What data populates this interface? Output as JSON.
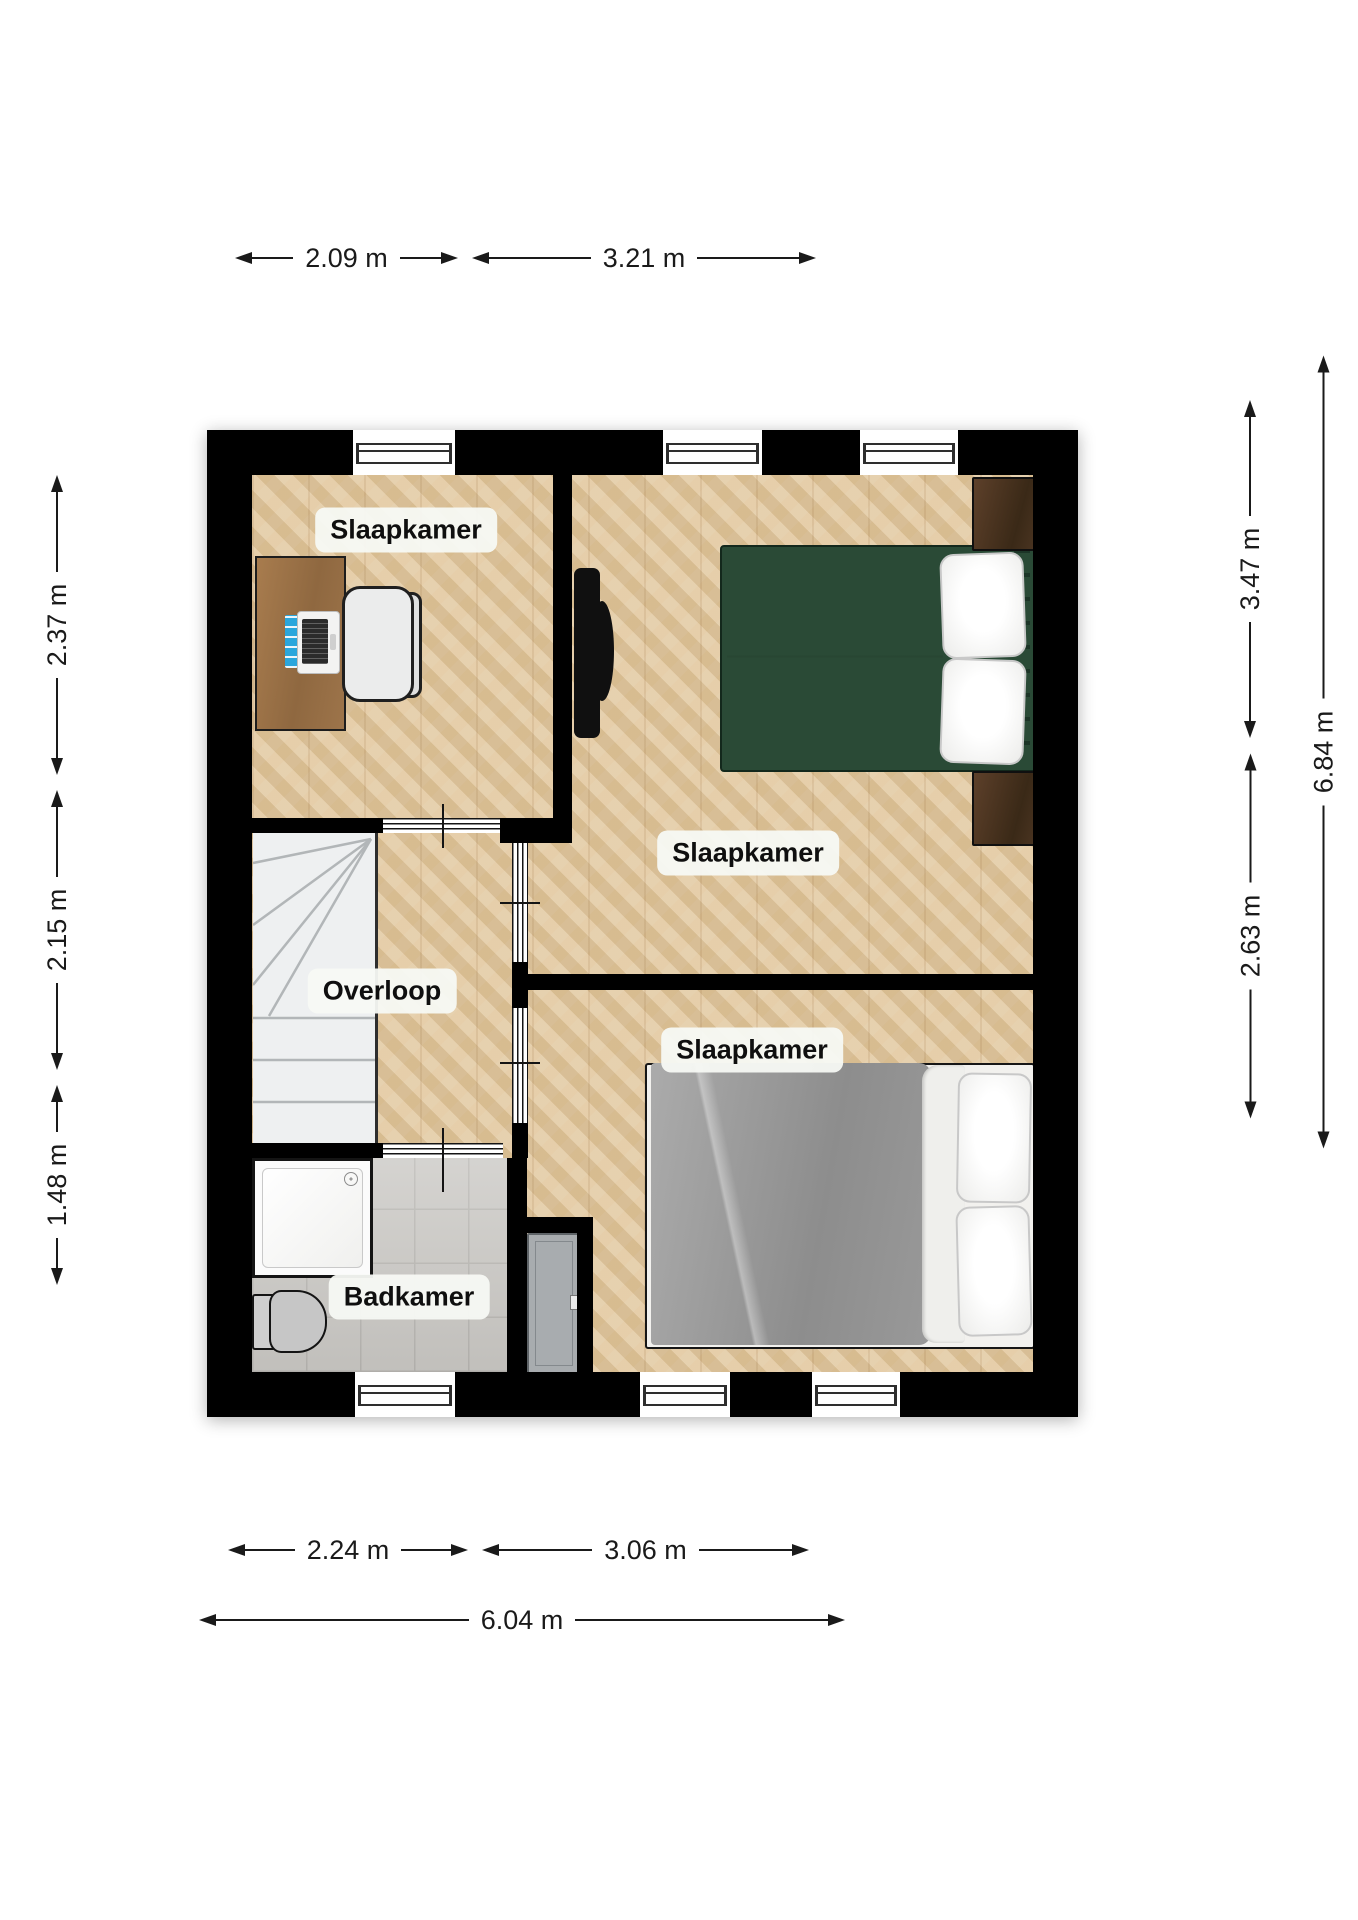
{
  "rooms": [
    {
      "id": "slaapkamer-top-left",
      "label": "Slaapkamer"
    },
    {
      "id": "slaapkamer-right",
      "label": "Slaapkamer"
    },
    {
      "id": "slaapkamer-bottom-right",
      "label": "Slaapkamer"
    },
    {
      "id": "overloop",
      "label": "Overloop"
    },
    {
      "id": "badkamer",
      "label": "Badkamer"
    }
  ],
  "dimensions": {
    "top": [
      {
        "label": "2.09 m"
      },
      {
        "label": "3.21 m"
      }
    ],
    "left": [
      {
        "label": "2.37 m"
      },
      {
        "label": "2.15 m"
      },
      {
        "label": "1.48 m"
      }
    ],
    "right": [
      {
        "label": "3.47 m"
      },
      {
        "label": "2.63 m"
      },
      {
        "label": "6.84 m"
      }
    ],
    "bottom": [
      {
        "label": "2.24 m"
      },
      {
        "label": "3.06 m"
      },
      {
        "label": "6.04 m"
      }
    ]
  },
  "furniture": [
    "desk",
    "office-chair",
    "laptop",
    "tv",
    "double-bed-green",
    "nightstand",
    "nightstand",
    "stairs",
    "shower",
    "toilet",
    "door",
    "double-bed-gray"
  ],
  "colors": {
    "wall": "#000000",
    "parquet": "#e6cba0",
    "tile": "#c9c7c3",
    "stairs_floor": "#eef0f1",
    "bed_frame_green": "#2a4a36",
    "duvet_gray": "#9a9a9a",
    "door_gray": "#a8acaf",
    "label_bg": "#f7f9f4",
    "desk_wood": "#9c7347",
    "nightstand_wood": "#4a3421",
    "dimension_line": "#1a1a1a"
  }
}
